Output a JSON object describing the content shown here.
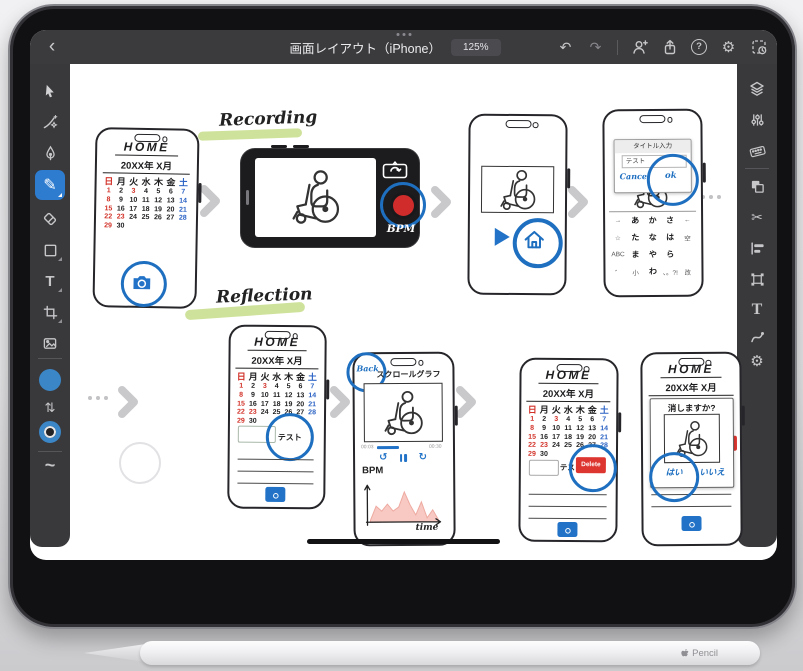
{
  "window": {
    "title": "画面レイアウト（iPhone）",
    "zoom_level": "125%"
  },
  "toolbars": {
    "left_tools": [
      "select",
      "lasso",
      "pen",
      "pencil",
      "eraser",
      "shape",
      "type",
      "crop",
      "image",
      "fill-color",
      "swap-colors",
      "stroke-color",
      "smooth"
    ],
    "active_tool": "pencil",
    "swatch_color": "#3b86c6",
    "right_panels": [
      "layers",
      "properties",
      "keyboard",
      "combine",
      "cut",
      "align",
      "transform",
      "type-styles",
      "curve",
      "settings"
    ]
  },
  "canvas": {
    "flow_labels": {
      "recording": "Recording",
      "reflection": "Reflection"
    },
    "highlight_color": "#cfe29b",
    "accent_blue": "#1e6fc0",
    "calendar": {
      "title": "HOME",
      "month": "20XX年 X月",
      "weekdays": [
        "日",
        "月",
        "火",
        "水",
        "木",
        "金",
        "土"
      ],
      "day_count": 30,
      "red_days": [
        1,
        3,
        8,
        15,
        22,
        23,
        29
      ],
      "blue_days": [
        7,
        14,
        21,
        28
      ]
    },
    "camera_screen": {
      "bpm_label": "BPM"
    },
    "title_dialog": {
      "title": "タイトル入力",
      "input_value": "テスト",
      "cancel_label": "Cancel",
      "ok_label": "ok",
      "keyboard_rows": [
        [
          "→",
          "あ",
          "か",
          "さ",
          "←"
        ],
        [
          "☆",
          "た",
          "な",
          "は",
          "空"
        ],
        [
          "ABC",
          "ま",
          "や",
          "ら",
          ""
        ],
        [
          "゛",
          "小",
          "わ",
          "、。?!",
          "改"
        ]
      ]
    },
    "test_input": {
      "value": "テスト"
    },
    "graph_screen": {
      "back_label": "Back",
      "title": "スクロールグラフ",
      "time_start": "00:03",
      "time_end": "00:30",
      "y_label": "BPM",
      "x_label": "time",
      "area_heights": [
        2,
        16,
        11,
        18,
        11,
        15,
        30,
        17,
        7,
        20,
        4,
        12,
        2
      ]
    },
    "delete_screen": {
      "input_value": "テスト",
      "delete_label": "Delete"
    },
    "confirm_dialog": {
      "question": "消しますか?",
      "yes_label": "はい",
      "no_label": "いいえ"
    }
  },
  "accessories": {
    "pencil_label": "Pencil"
  }
}
